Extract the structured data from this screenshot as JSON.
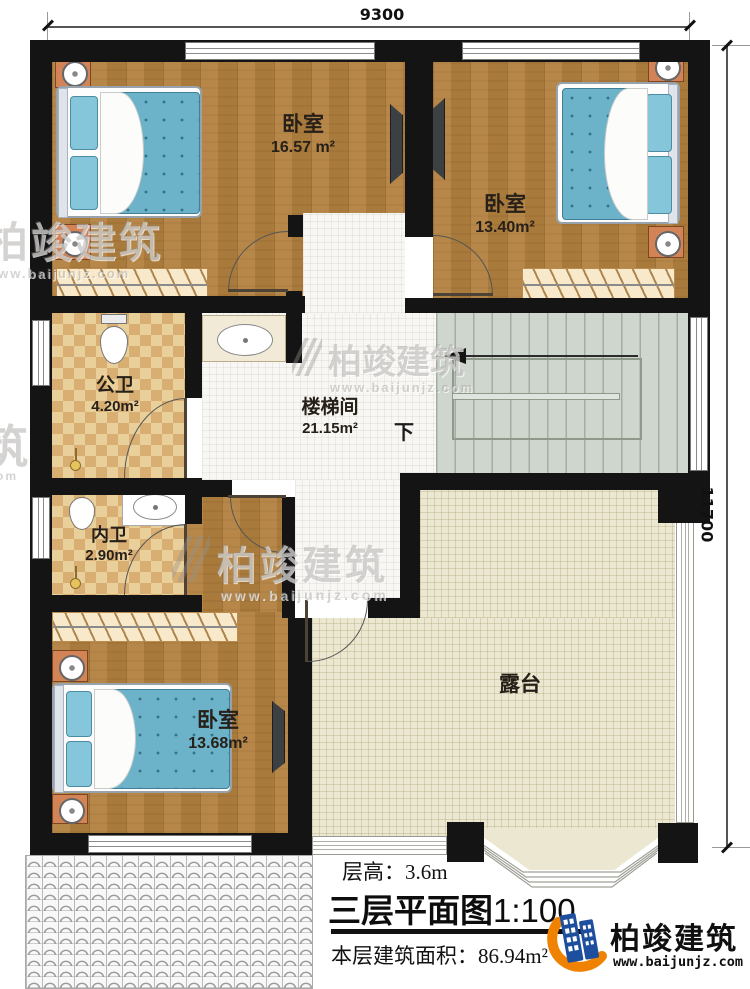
{
  "plan": {
    "dim_top": "9300",
    "dim_right": "11700",
    "rooms": {
      "bedroom1": {
        "name": "卧室",
        "area": "16.57 m²"
      },
      "bedroom2": {
        "name": "卧室",
        "area": "13.40m²"
      },
      "bedroom3": {
        "name": "卧室",
        "area": "13.68m²"
      },
      "public_bath": {
        "name": "公卫",
        "area": "4.20m²"
      },
      "inner_bath": {
        "name": "内卫",
        "area": "2.90m²"
      },
      "stair_hall": {
        "name": "楼梯间",
        "area": "21.15m²"
      },
      "terrace": {
        "name": "露台"
      }
    },
    "stair_down_label": "下"
  },
  "footer": {
    "floor_height": "层高：3.6m",
    "title": "三层平面图",
    "scale": "1:100",
    "area_label": "本层建筑面积：",
    "area_value": "86.94m²"
  },
  "logo": {
    "company": "柏竣建筑",
    "website": "www.baijunjz.com"
  },
  "watermark": {
    "brand": "柏竣建筑",
    "site": "www.baijunjz.com",
    "partial_char": "筑",
    "partial_site": ".com"
  },
  "colors": {
    "wood": "#b1803e",
    "wall": "#141414",
    "bath_floor": "#e9cf9a",
    "stair": "#cfd6ce",
    "terrace": "#ece7d1",
    "bed": "#6cb2c9",
    "accent_orange": "#ef8200",
    "logo_blue": "#1d4f9e"
  }
}
